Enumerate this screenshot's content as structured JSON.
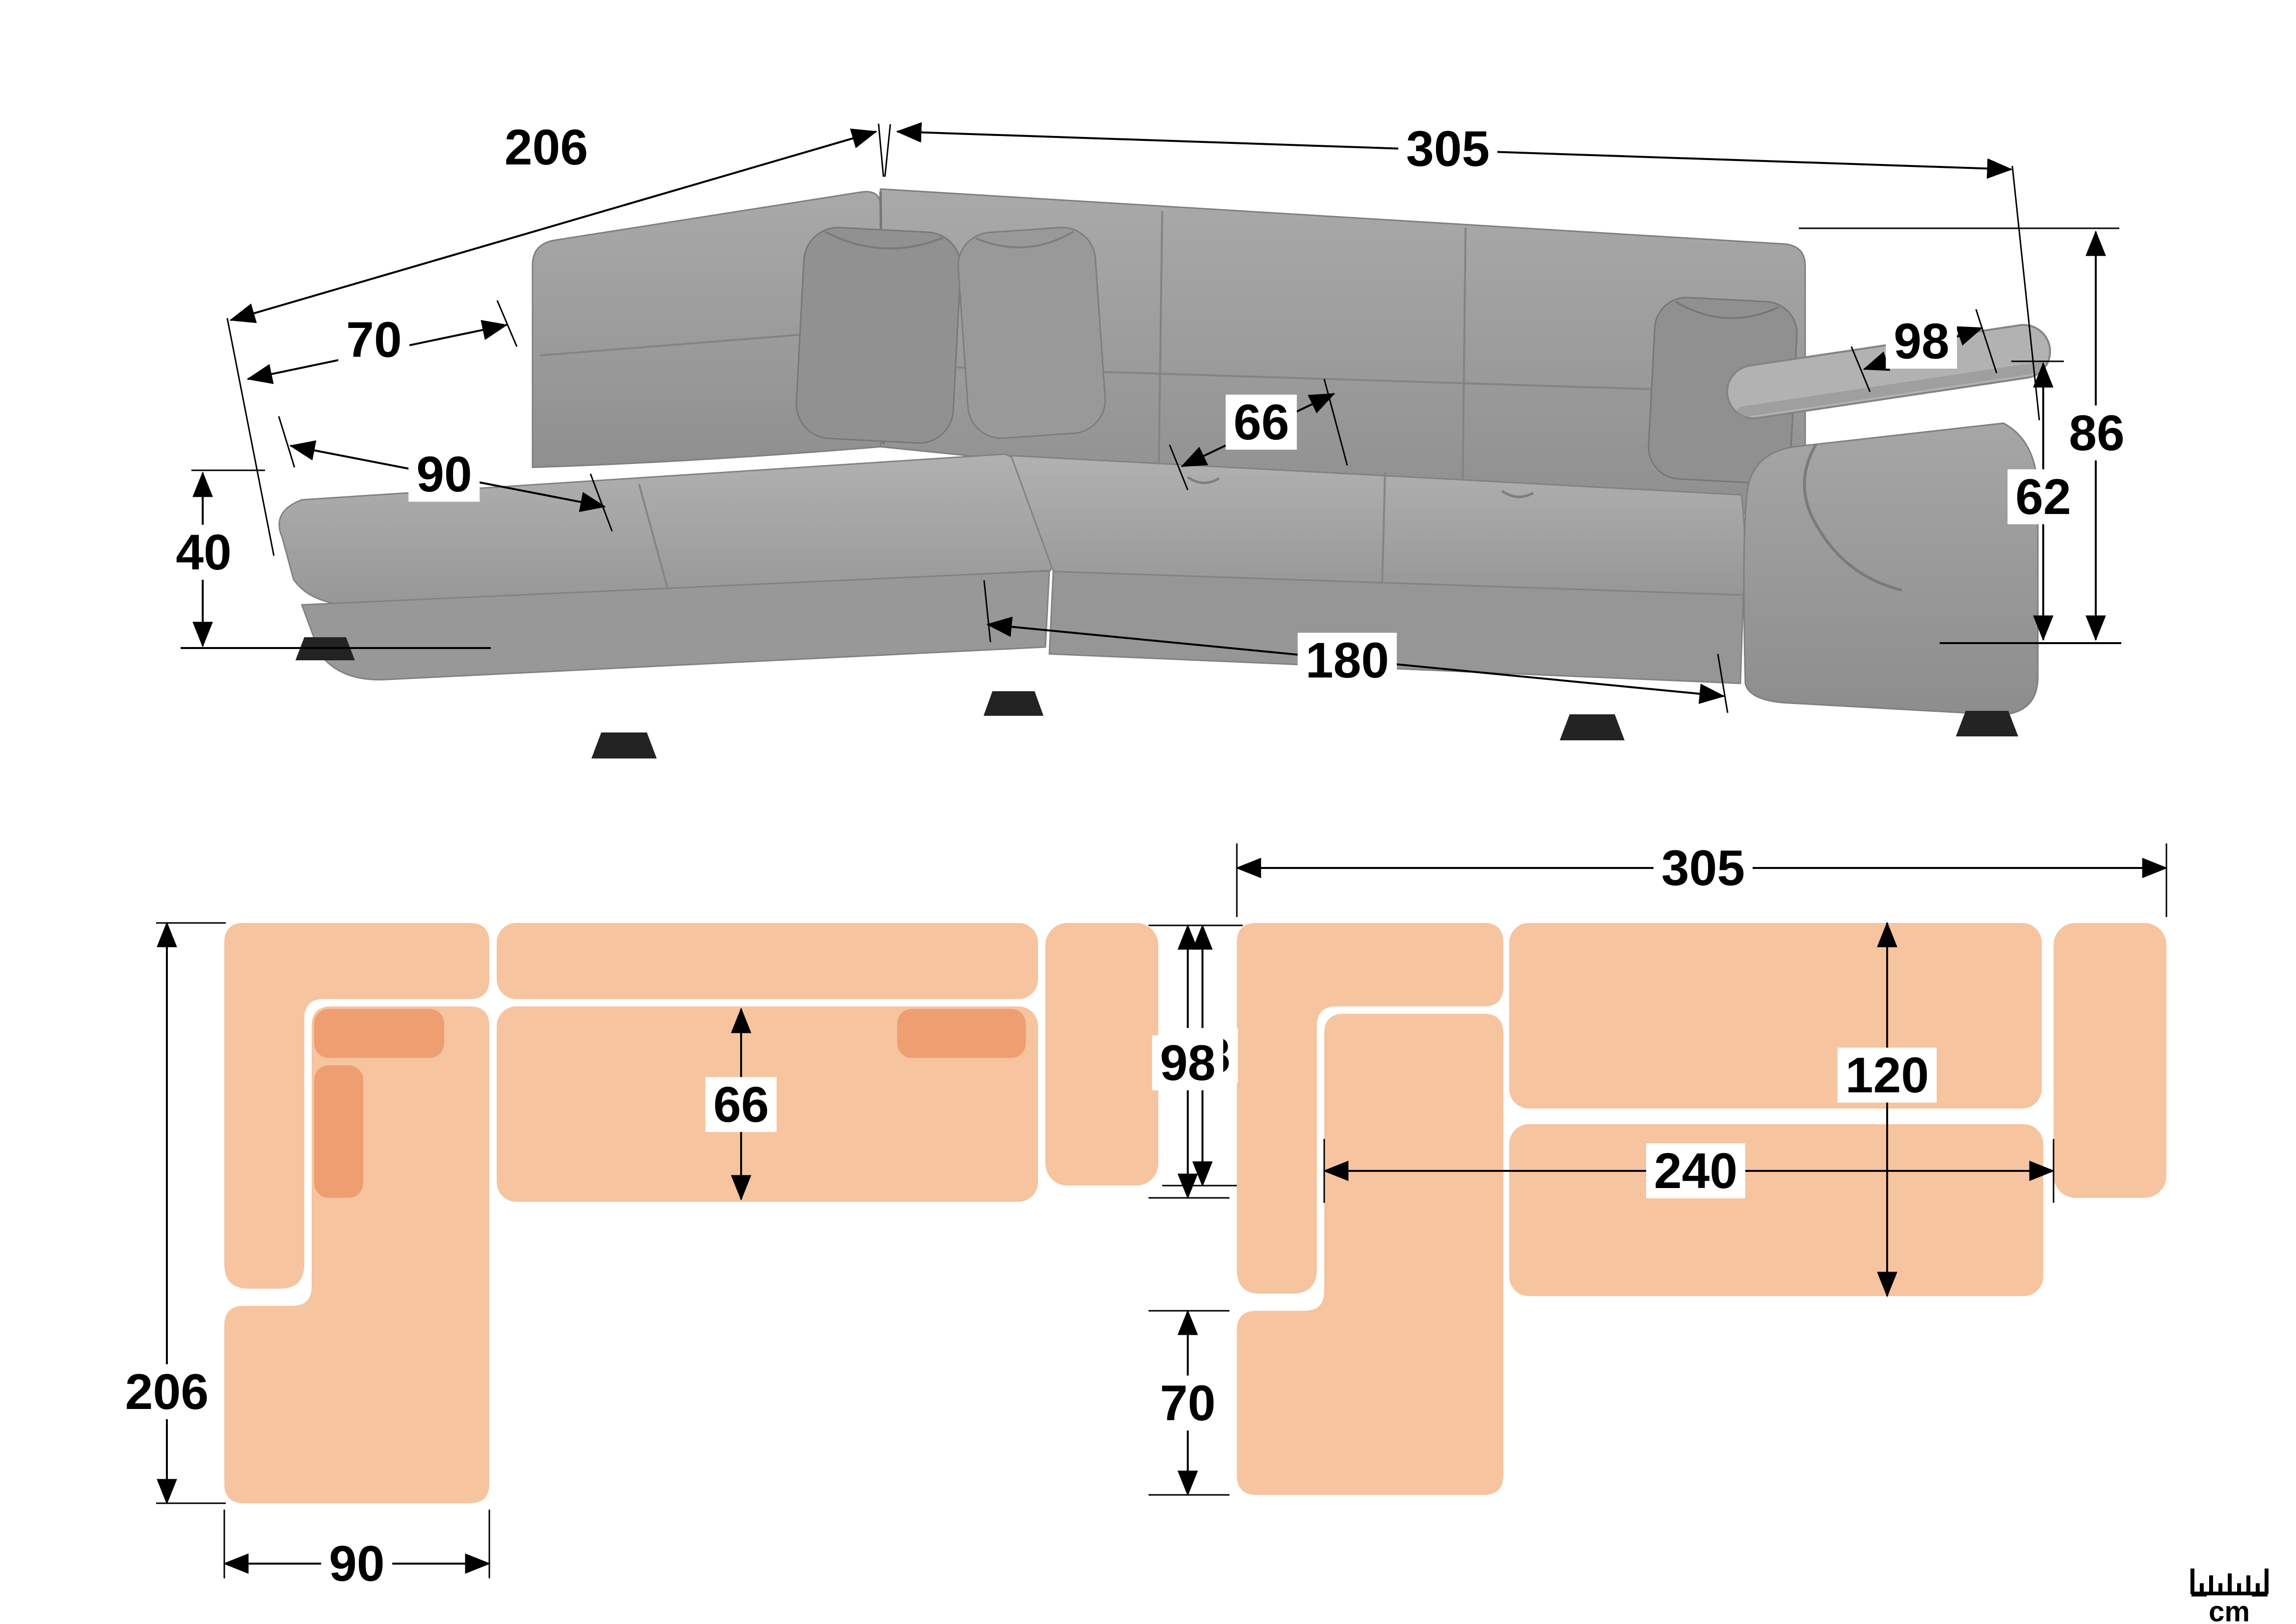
{
  "colors": {
    "plan_fill": "#F6C49E",
    "plan_accent": "#EE9E71",
    "line": "#000000",
    "sofa_base": "#9c9c9c",
    "sofa_light": "#aeaeae",
    "sofa_dark": "#8a8a8a",
    "leg": "#232323"
  },
  "photo_view": {
    "dims": {
      "back_left_length": "206",
      "back_right_length": "305",
      "backrest_depth": "70",
      "chaise_width": "90",
      "seat_depth": "66",
      "armrest_length": "98",
      "total_height": "86",
      "arm_height": "62",
      "seat_height": "40",
      "front_length": "180"
    }
  },
  "floor_plan": {
    "dims": {
      "total_depth": "206",
      "chaise_width": "90",
      "seat_depth": "66",
      "section_depth": "98"
    }
  },
  "sleeping_plan": {
    "dims": {
      "total_width": "305",
      "section_depth": "98",
      "chaise_extension": "70",
      "bed_width": "120",
      "bed_length": "240"
    }
  },
  "unit_badge": {
    "label": "cm"
  }
}
